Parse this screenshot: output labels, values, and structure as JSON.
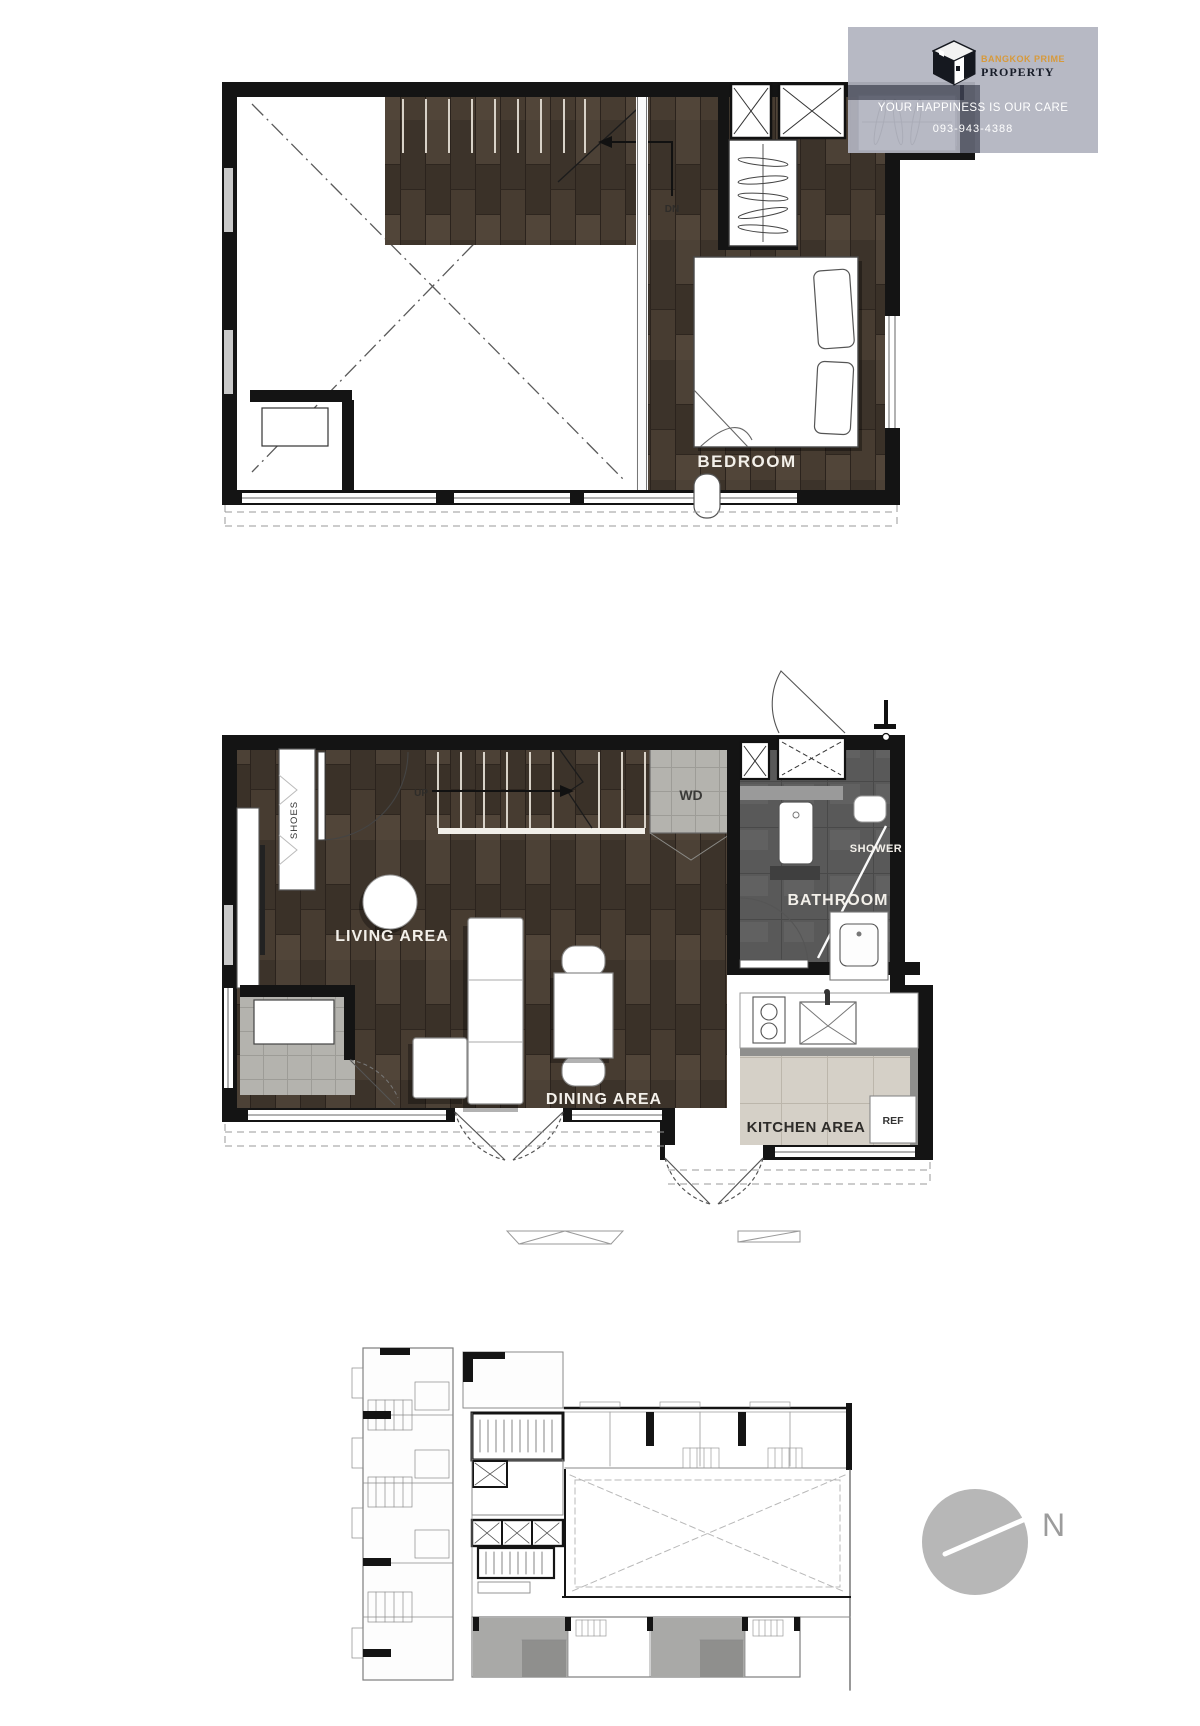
{
  "watermark": {
    "brand_line1": "BANGKOK PRIME",
    "brand_line2": "PROPERTY",
    "slogan": "YOUR HAPPINESS IS OUR CARE",
    "phone": "093-943-4388",
    "panel_color": "#b1b4c0",
    "brand_color": "#d79a3b"
  },
  "plan_upper": {
    "labels": {
      "bedroom": "BEDROOM",
      "stairs_down": "DN"
    }
  },
  "plan_lower": {
    "labels": {
      "living": "LIVING AREA",
      "dining": "DINING AREA",
      "kitchen": "KITCHEN AREA",
      "bathroom": "BATHROOM",
      "shower": "SHOWER",
      "washer_dryer": "WD",
      "refrigerator": "REF",
      "shoes": "SHOES",
      "stairs_up": "UP"
    }
  },
  "key_plan": {
    "north_label": "N"
  },
  "colors": {
    "wall": "#141414",
    "wood_floor": "#43392f",
    "bath_tile": "#595959",
    "kitchen_tile": "#d5d0c7",
    "highlight_unit": "#a9a9a7",
    "compass": "#b7b7b7"
  }
}
